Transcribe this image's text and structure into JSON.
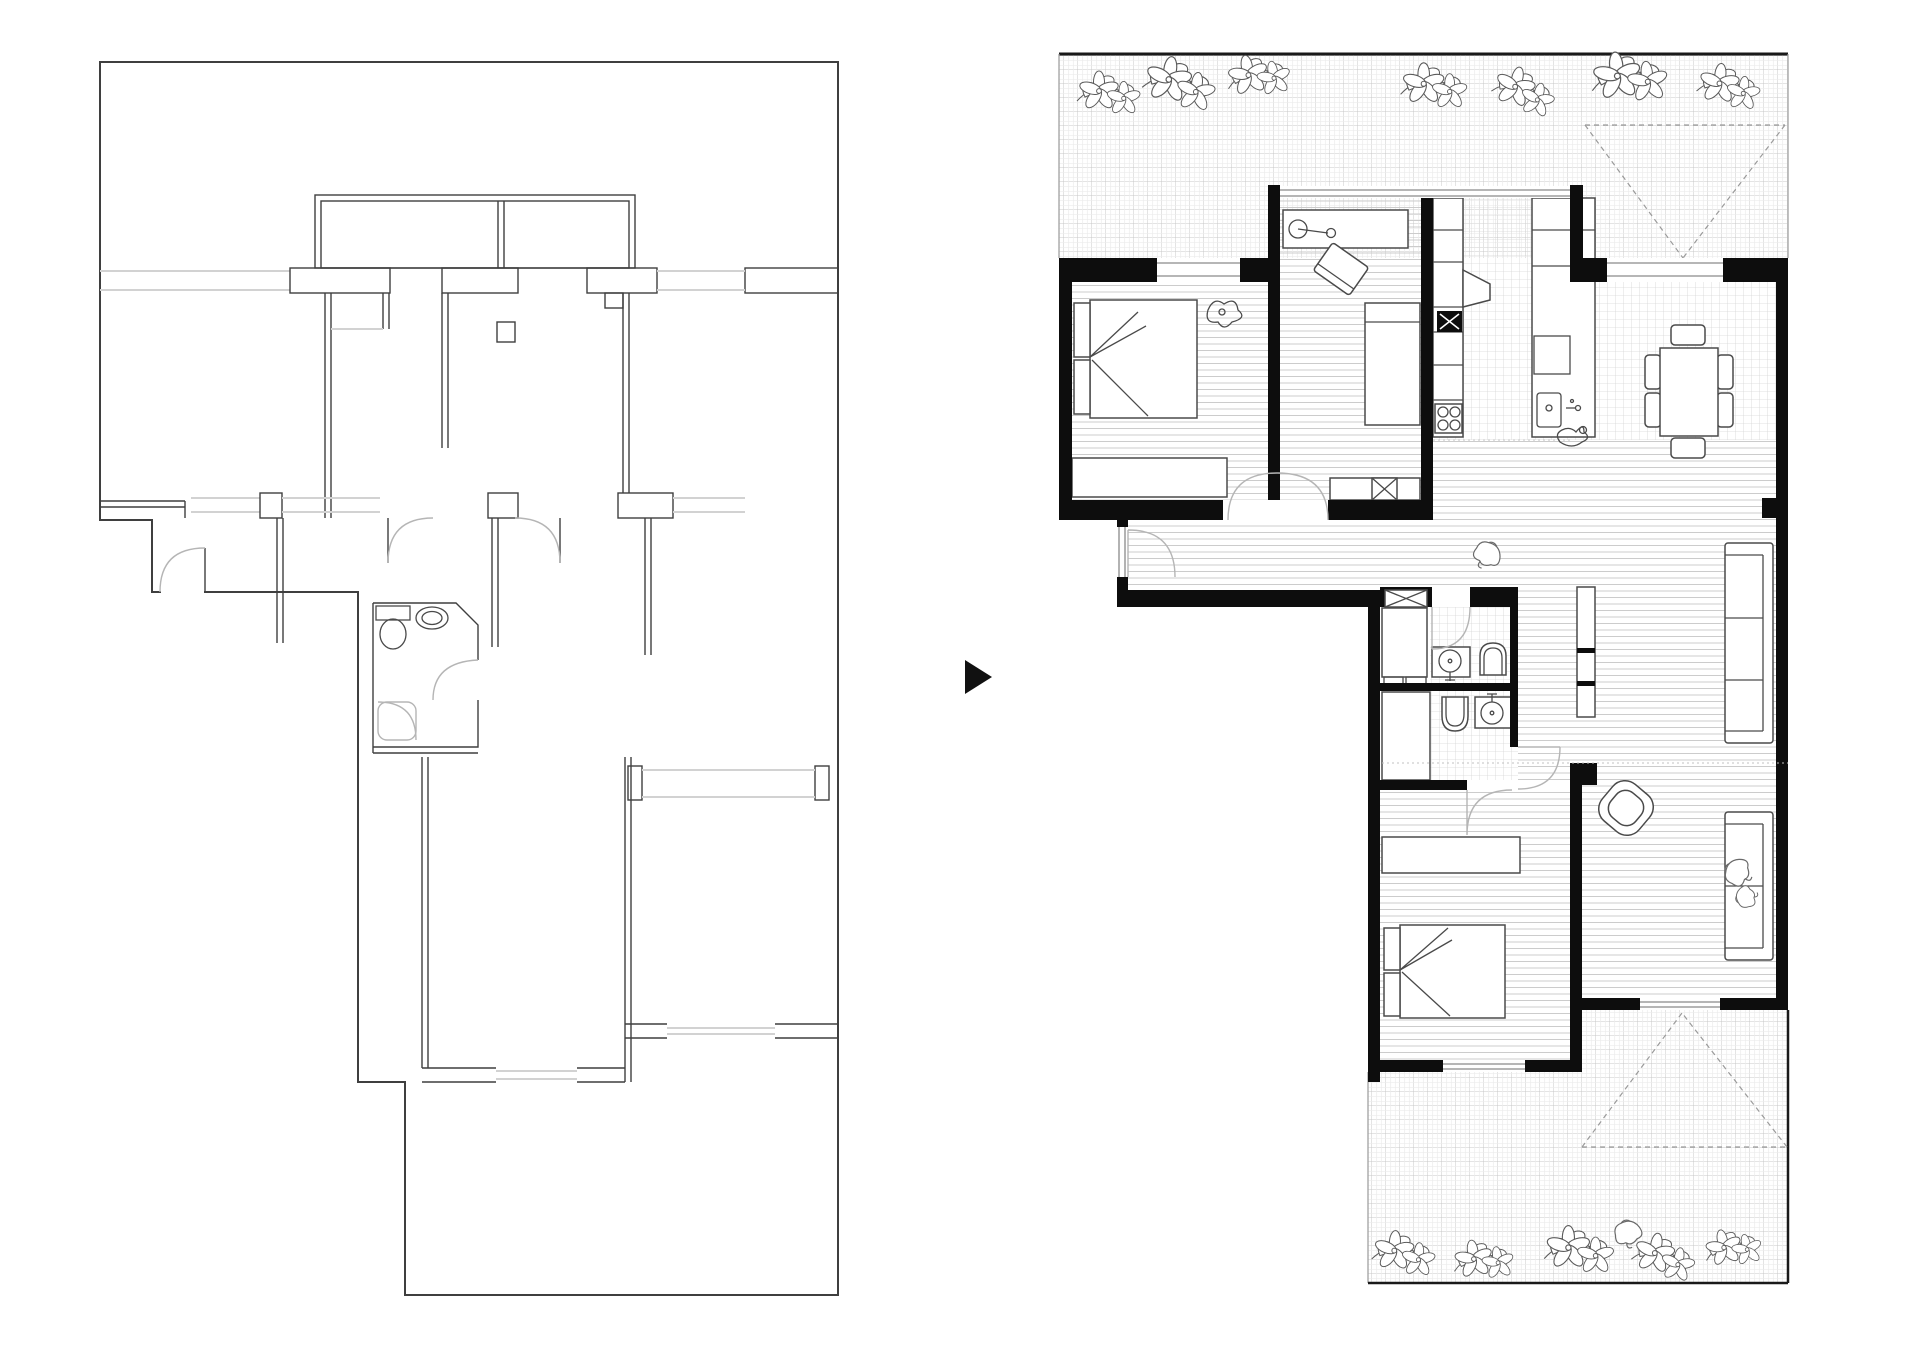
{
  "page": {
    "title": "Apartment renovation floor plans — existing state and proposed state",
    "background_color": "#ffffff"
  },
  "arrow": {
    "glyph": "▶",
    "meaning": "transforms-into",
    "color": "#111111"
  },
  "panels": {
    "before": {
      "label": "existing-floor-plan",
      "style": "thin outline drawing, unfurnished",
      "line_color": "#3f3f3f",
      "window_color": "#d2d2d2",
      "features": [
        "open-shell-rooms",
        "double-line-partitions",
        "door-swing-arcs",
        "bathroom-with-toilet-and-sink",
        "window-openings",
        "rear-terrace-outline"
      ]
    },
    "after": {
      "label": "proposed-floor-plan",
      "style": "rendered plan with solid black walls, floor hatching and furniture",
      "wall_color": "#0d0d0d",
      "wood_floor_line_color": "#cccccc",
      "tile_grid_color": "#d6d6d6",
      "terrace_grid_color": "#cfcfcf",
      "awning_dash_color": "#9a9a9a",
      "rooms": [
        "terrace-north-with-plants",
        "bedroom-1",
        "study",
        "kitchen",
        "dining-area",
        "entry-corridor",
        "bathroom-1",
        "bathroom-2",
        "bedroom-2",
        "living-room",
        "terrace-south-with-plants"
      ],
      "furniture_icons": [
        "double-bed-icon",
        "desk-with-lamp-icon",
        "desk-chair-icon",
        "daybed-icon",
        "kitchen-counter-icon",
        "hob-icon",
        "oven-x-icon",
        "kitchen-island-sink-icon",
        "dining-table-six-chairs-icon",
        "shelf-unit-icon",
        "sofa-icon",
        "armchair-icon",
        "washing-machine-x-icon",
        "round-basin-icon",
        "toilet-icon",
        "wardrobe-icon",
        "dresser-icon",
        "person-icon",
        "duck-icon",
        "flower-cluster-icon",
        "awning-dashed-triangle-icon"
      ]
    }
  }
}
